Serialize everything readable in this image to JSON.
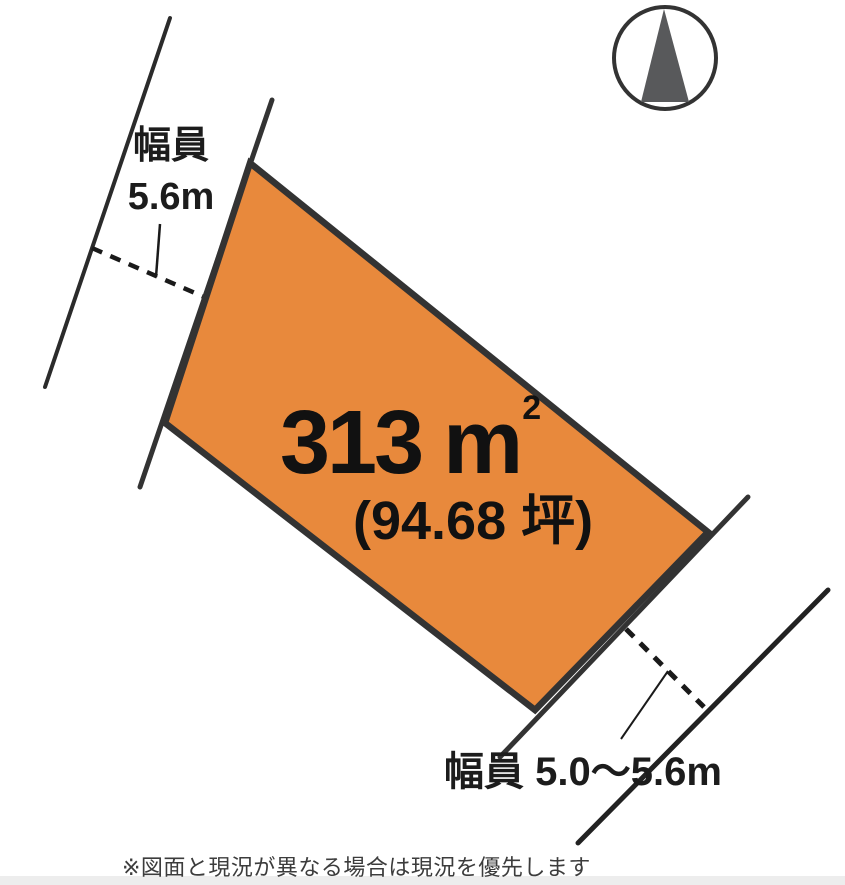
{
  "diagram": {
    "title": "land-plot-diagram",
    "compass": {
      "icon": "north-arrow-icon"
    },
    "parcel": {
      "area_value": "313 m",
      "area_superscript": "2",
      "area_tsubo": "(94.68 坪)",
      "fill_color": "#E8893C",
      "border_color": "#333333"
    },
    "road_left": {
      "label_line1": "幅員",
      "label_line2": "5.6m"
    },
    "road_bottom": {
      "label": "幅員 5.0～5.6m"
    },
    "footer_note": "※図面と現況が異なる場合は現況を優先します",
    "colors": {
      "line": "#2b2b2b",
      "compass_triangle": "#58595b",
      "bottom_strip": "#ededed"
    }
  }
}
